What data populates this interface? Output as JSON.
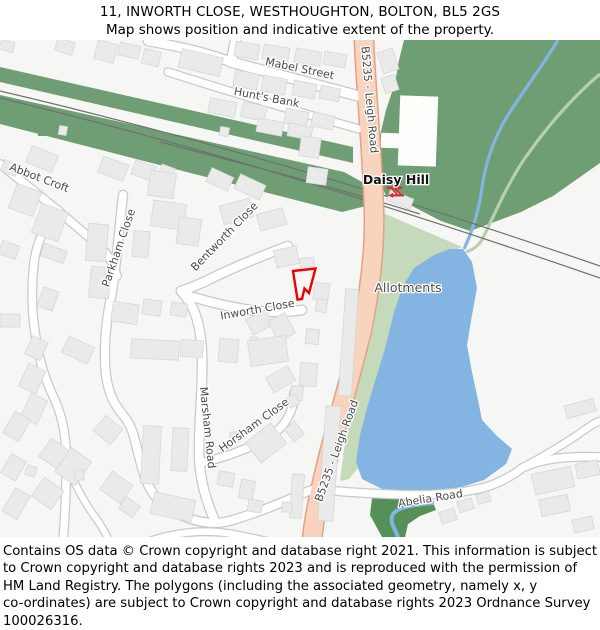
{
  "header": {
    "line1": "11, INWORTH CLOSE, WESTHOUGHTON, BOLTON, BL5 2GS",
    "line2": "Map shows position and indicative extent of the property."
  },
  "map": {
    "labels": {
      "mabel_street": "Mabel Street",
      "hunts_bank": "Hunt's Bank",
      "abbot_croft": "Abbot Croft",
      "parkham_close": "Parkham Close",
      "bentworth_close": "Bentworth Close",
      "inworth_close": "Inworth Close",
      "marsham_road": "Marsham Road",
      "horsham_close": "Horsham Close",
      "daisy_hill": "Daisy Hill",
      "allotments": "Allotments",
      "abelia_road": "Abelia Road",
      "b5235_leigh_road": "B5235 - Leigh Road"
    },
    "colors": {
      "property_outline": "#ee0000",
      "woodland": "#6f9e74",
      "allotments": "#c4dabb",
      "water": "#84b5e2",
      "riverbank": "#559058",
      "path_green": "#b9d0ae",
      "a_road_fill": "#f8d3bd",
      "a_road_border": "#e2a284",
      "minor_road_fill": "#ffffff",
      "minor_road_border": "#c9c9c9",
      "rail_icon_red": "#d82c2c",
      "railway": "#707070"
    }
  },
  "footer": {
    "lines": [
      "Contains OS data © Crown copyright and database right 2021. This information is subject",
      "to Crown copyright and database rights 2023 and is reproduced with the permission of",
      "HM Land Registry. The polygons (including the associated geometry, namely x, y",
      "co-ordinates) are subject to Crown copyright and database rights 2023 Ordnance Survey",
      "100026316."
    ]
  }
}
